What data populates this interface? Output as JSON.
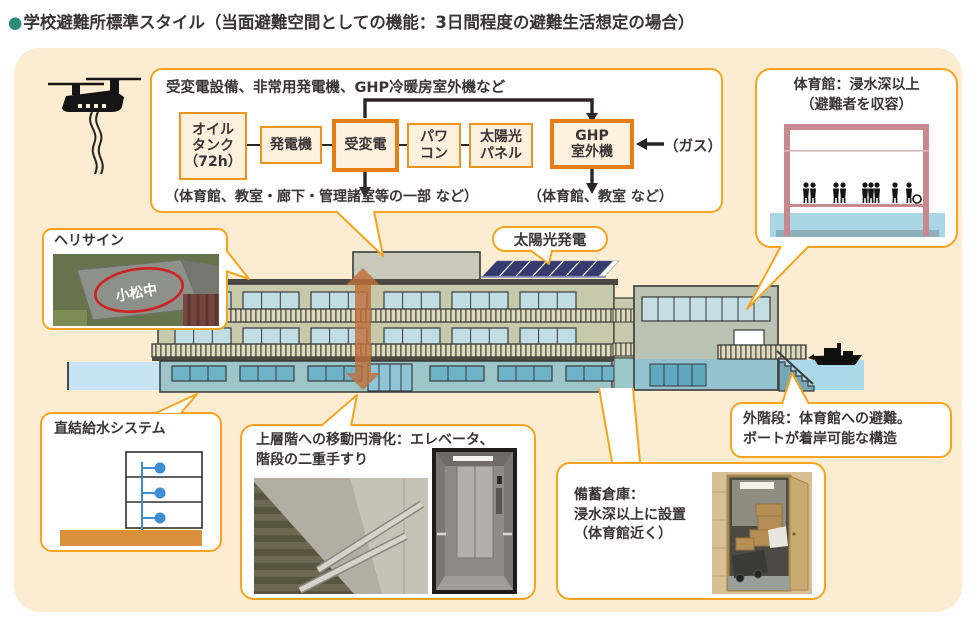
{
  "title": {
    "bullet": "●",
    "text": "学校避難所標準スタイル（当面避難空間としての機能：3日間程度の避難生活想定の場合）"
  },
  "colors": {
    "panel_bg": "#fcecd1",
    "accent_orange": "#f6a41f",
    "emphasis_orange": "#e87d14",
    "bullet_teal": "#2a8c7d",
    "water_blue": "#abd9e9",
    "building_olive": "#c7c9ab",
    "ground_teal": "#9cc6c8",
    "gym_frame_pink": "#c8898e",
    "arrow_orange": "#c06f3c"
  },
  "icons": {
    "helicopter": "helicopter-icon",
    "boat": "boat-icon"
  },
  "flowchart": {
    "header": "受変電設備、非常用発電機、GHP冷暖房室外機など",
    "boxes": [
      {
        "label": "オイル\nタンク\n（72h）"
      },
      {
        "label": "発電機"
      },
      {
        "label": "受変電"
      },
      {
        "label": "パワ\nコン"
      },
      {
        "label": "太陽光\nパネル"
      },
      {
        "label": "GHP\n室外機"
      }
    ],
    "gas_label": "（ガス）",
    "caption_left": "（体育館、教室・廊下・管理諸室等の一部 など）",
    "caption_right": "（体育館、教室 など）"
  },
  "callouts": {
    "gym": {
      "title": "体育館：浸水深以上\n（避難者を収容）"
    },
    "helisign": {
      "label": "ヘリサイン",
      "roof_text": "小松中"
    },
    "solar": {
      "label": "太陽光発電"
    },
    "water_supply": {
      "title": "直結給水システム"
    },
    "mobility": {
      "title": "上層階への移動円滑化：エレベータ、\n階段の二重手すり"
    },
    "storage": {
      "title": "備蓄倉庫：\n浸水深以上に設置\n（体育館近く）"
    },
    "ext_stairs": {
      "title": "外階段：体育館への避難。\nボートが着岸可能な構造"
    }
  }
}
